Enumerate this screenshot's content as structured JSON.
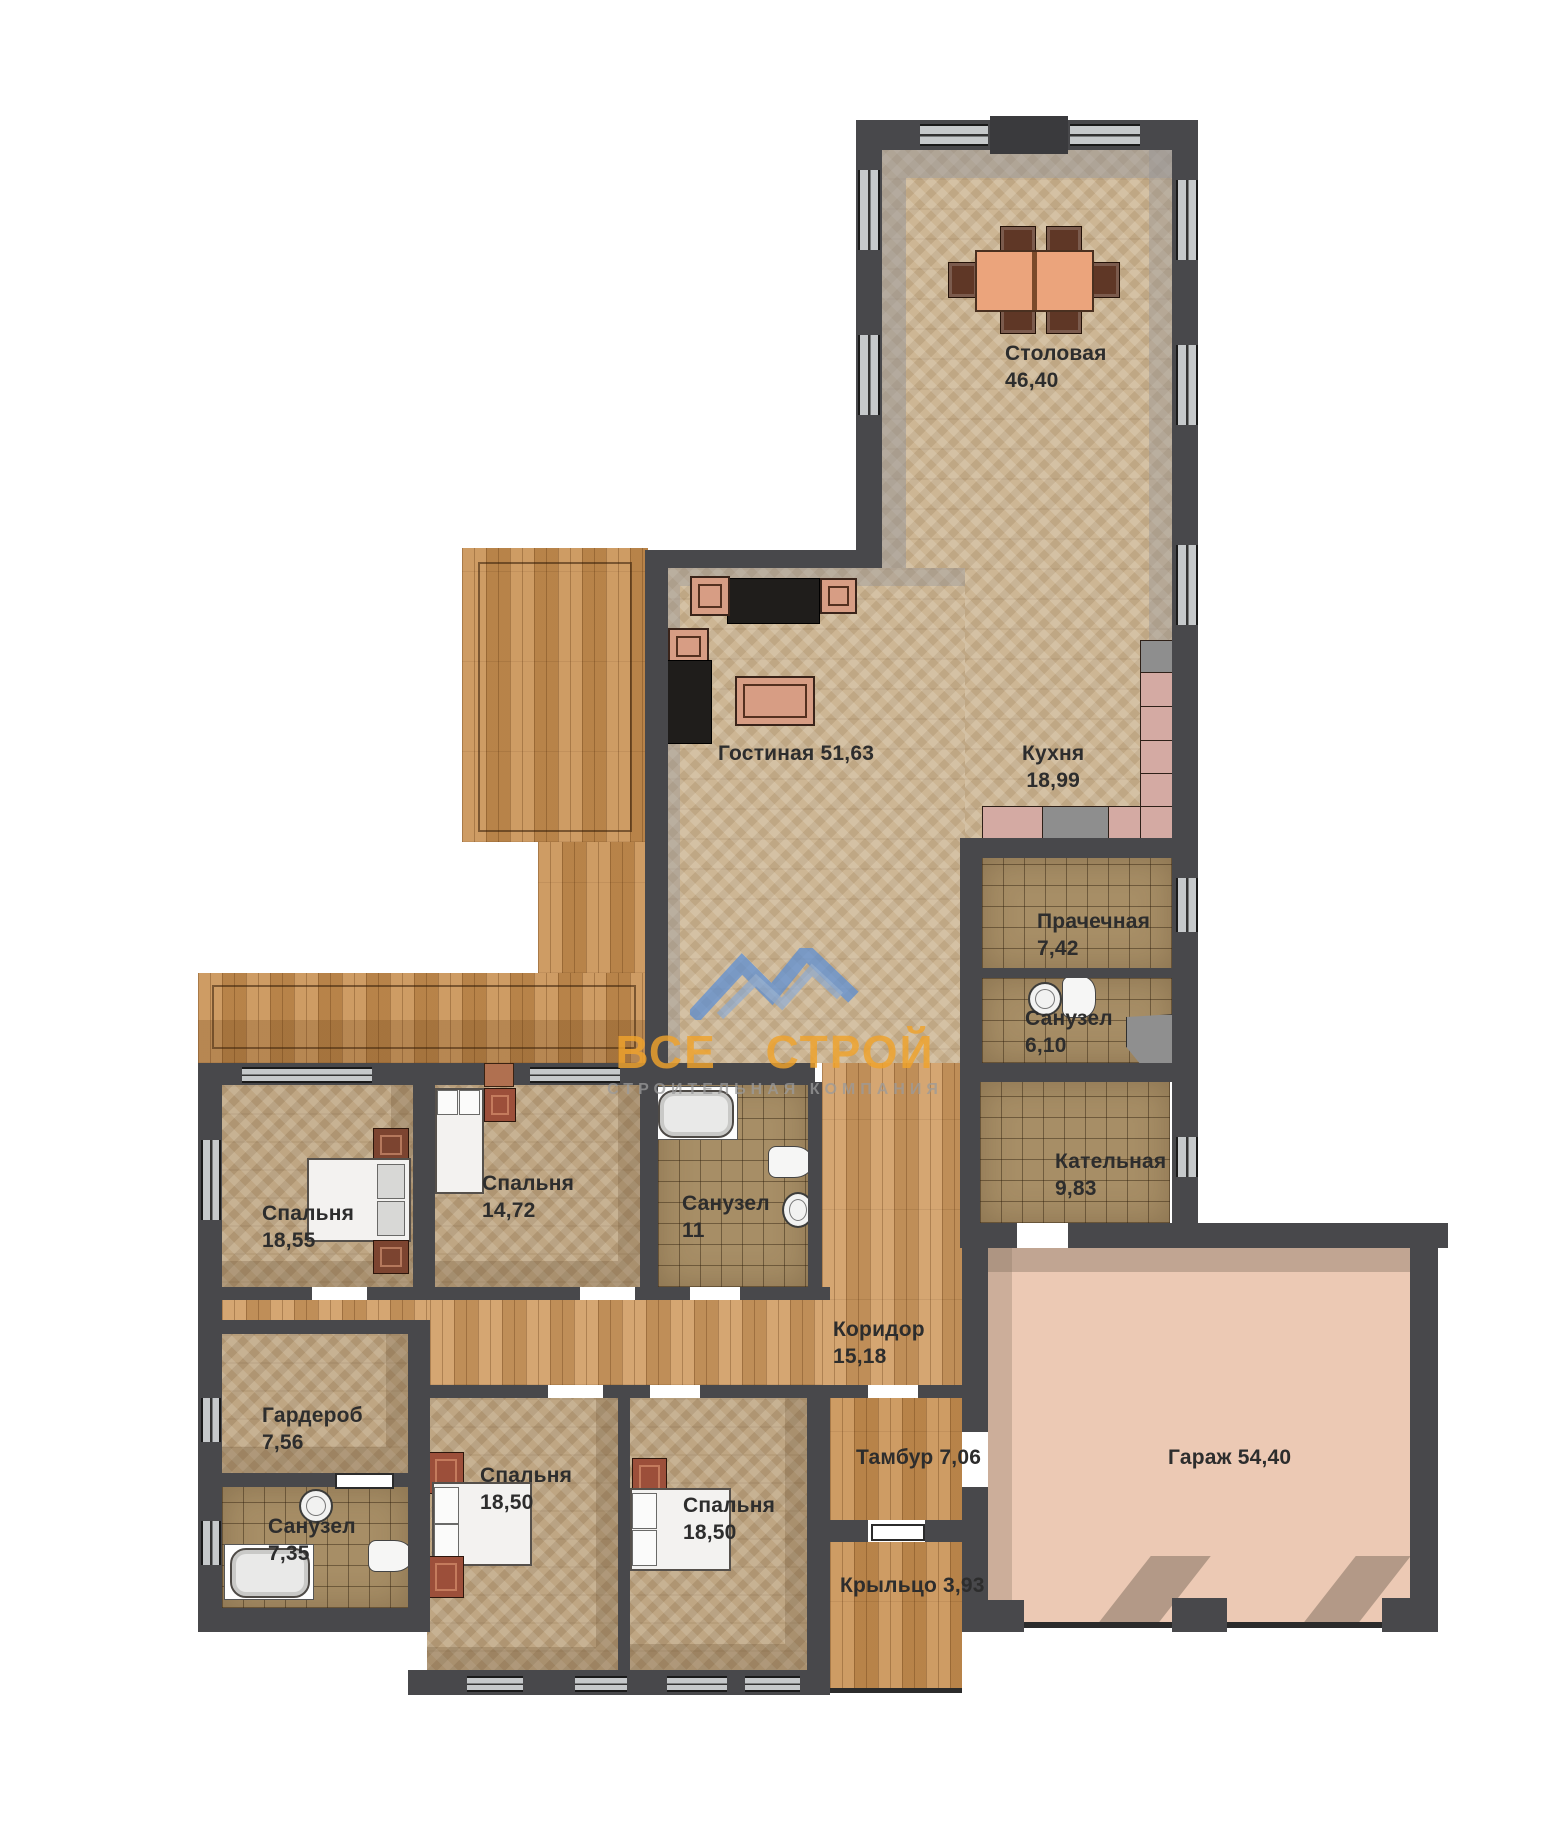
{
  "plan": {
    "rooms": [
      {
        "id": "dining",
        "label": "Столовая",
        "area": "46,40"
      },
      {
        "id": "living",
        "label": "Гостиная",
        "area": "51,63"
      },
      {
        "id": "kitchen",
        "label": "Кухня",
        "area": "18,99"
      },
      {
        "id": "laundry",
        "label": "Прачечная",
        "area": "7,42"
      },
      {
        "id": "bath-610",
        "label": "Санузел",
        "area": "6,10"
      },
      {
        "id": "boiler",
        "label": "Кательная",
        "area": "9,83"
      },
      {
        "id": "bedroom-1855",
        "label": "Спальня",
        "area": "18,55"
      },
      {
        "id": "bedroom-1472",
        "label": "Спальня",
        "area": "14,72"
      },
      {
        "id": "bath-11",
        "label": "Санузел",
        "area": "11"
      },
      {
        "id": "corridor",
        "label": "Коридор",
        "area": "15,18"
      },
      {
        "id": "wardrobe",
        "label": "Гардероб",
        "area": "7,56"
      },
      {
        "id": "bath-735",
        "label": "Санузел",
        "area": "7,35"
      },
      {
        "id": "bedroom-1850-left",
        "label": "Спальня",
        "area": "18,50"
      },
      {
        "id": "bedroom-1850-right",
        "label": "Спальня",
        "area": "18,50"
      },
      {
        "id": "vestibule",
        "label": "Тамбур",
        "area": "7,06"
      },
      {
        "id": "porch",
        "label": "Крыльцо",
        "area": "3,93"
      },
      {
        "id": "garage",
        "label": "Гараж",
        "area": "54,40"
      }
    ],
    "watermark": {
      "title": "ВСЕ СТРОЙ",
      "subtitle": "СТРОИТЕЛЬНАЯ КОМПАНИЯ"
    },
    "colors": {
      "wall": "#48484b",
      "floor_wood": "#cdb694",
      "floor_deck": "#c78e4f",
      "floor_tile": "#a78e66",
      "floor_garage": "#ecc9b4",
      "counter": "#d4aaa3",
      "accent_logo": "#f0a32c",
      "logo_blue": "#5b8fd6"
    }
  }
}
